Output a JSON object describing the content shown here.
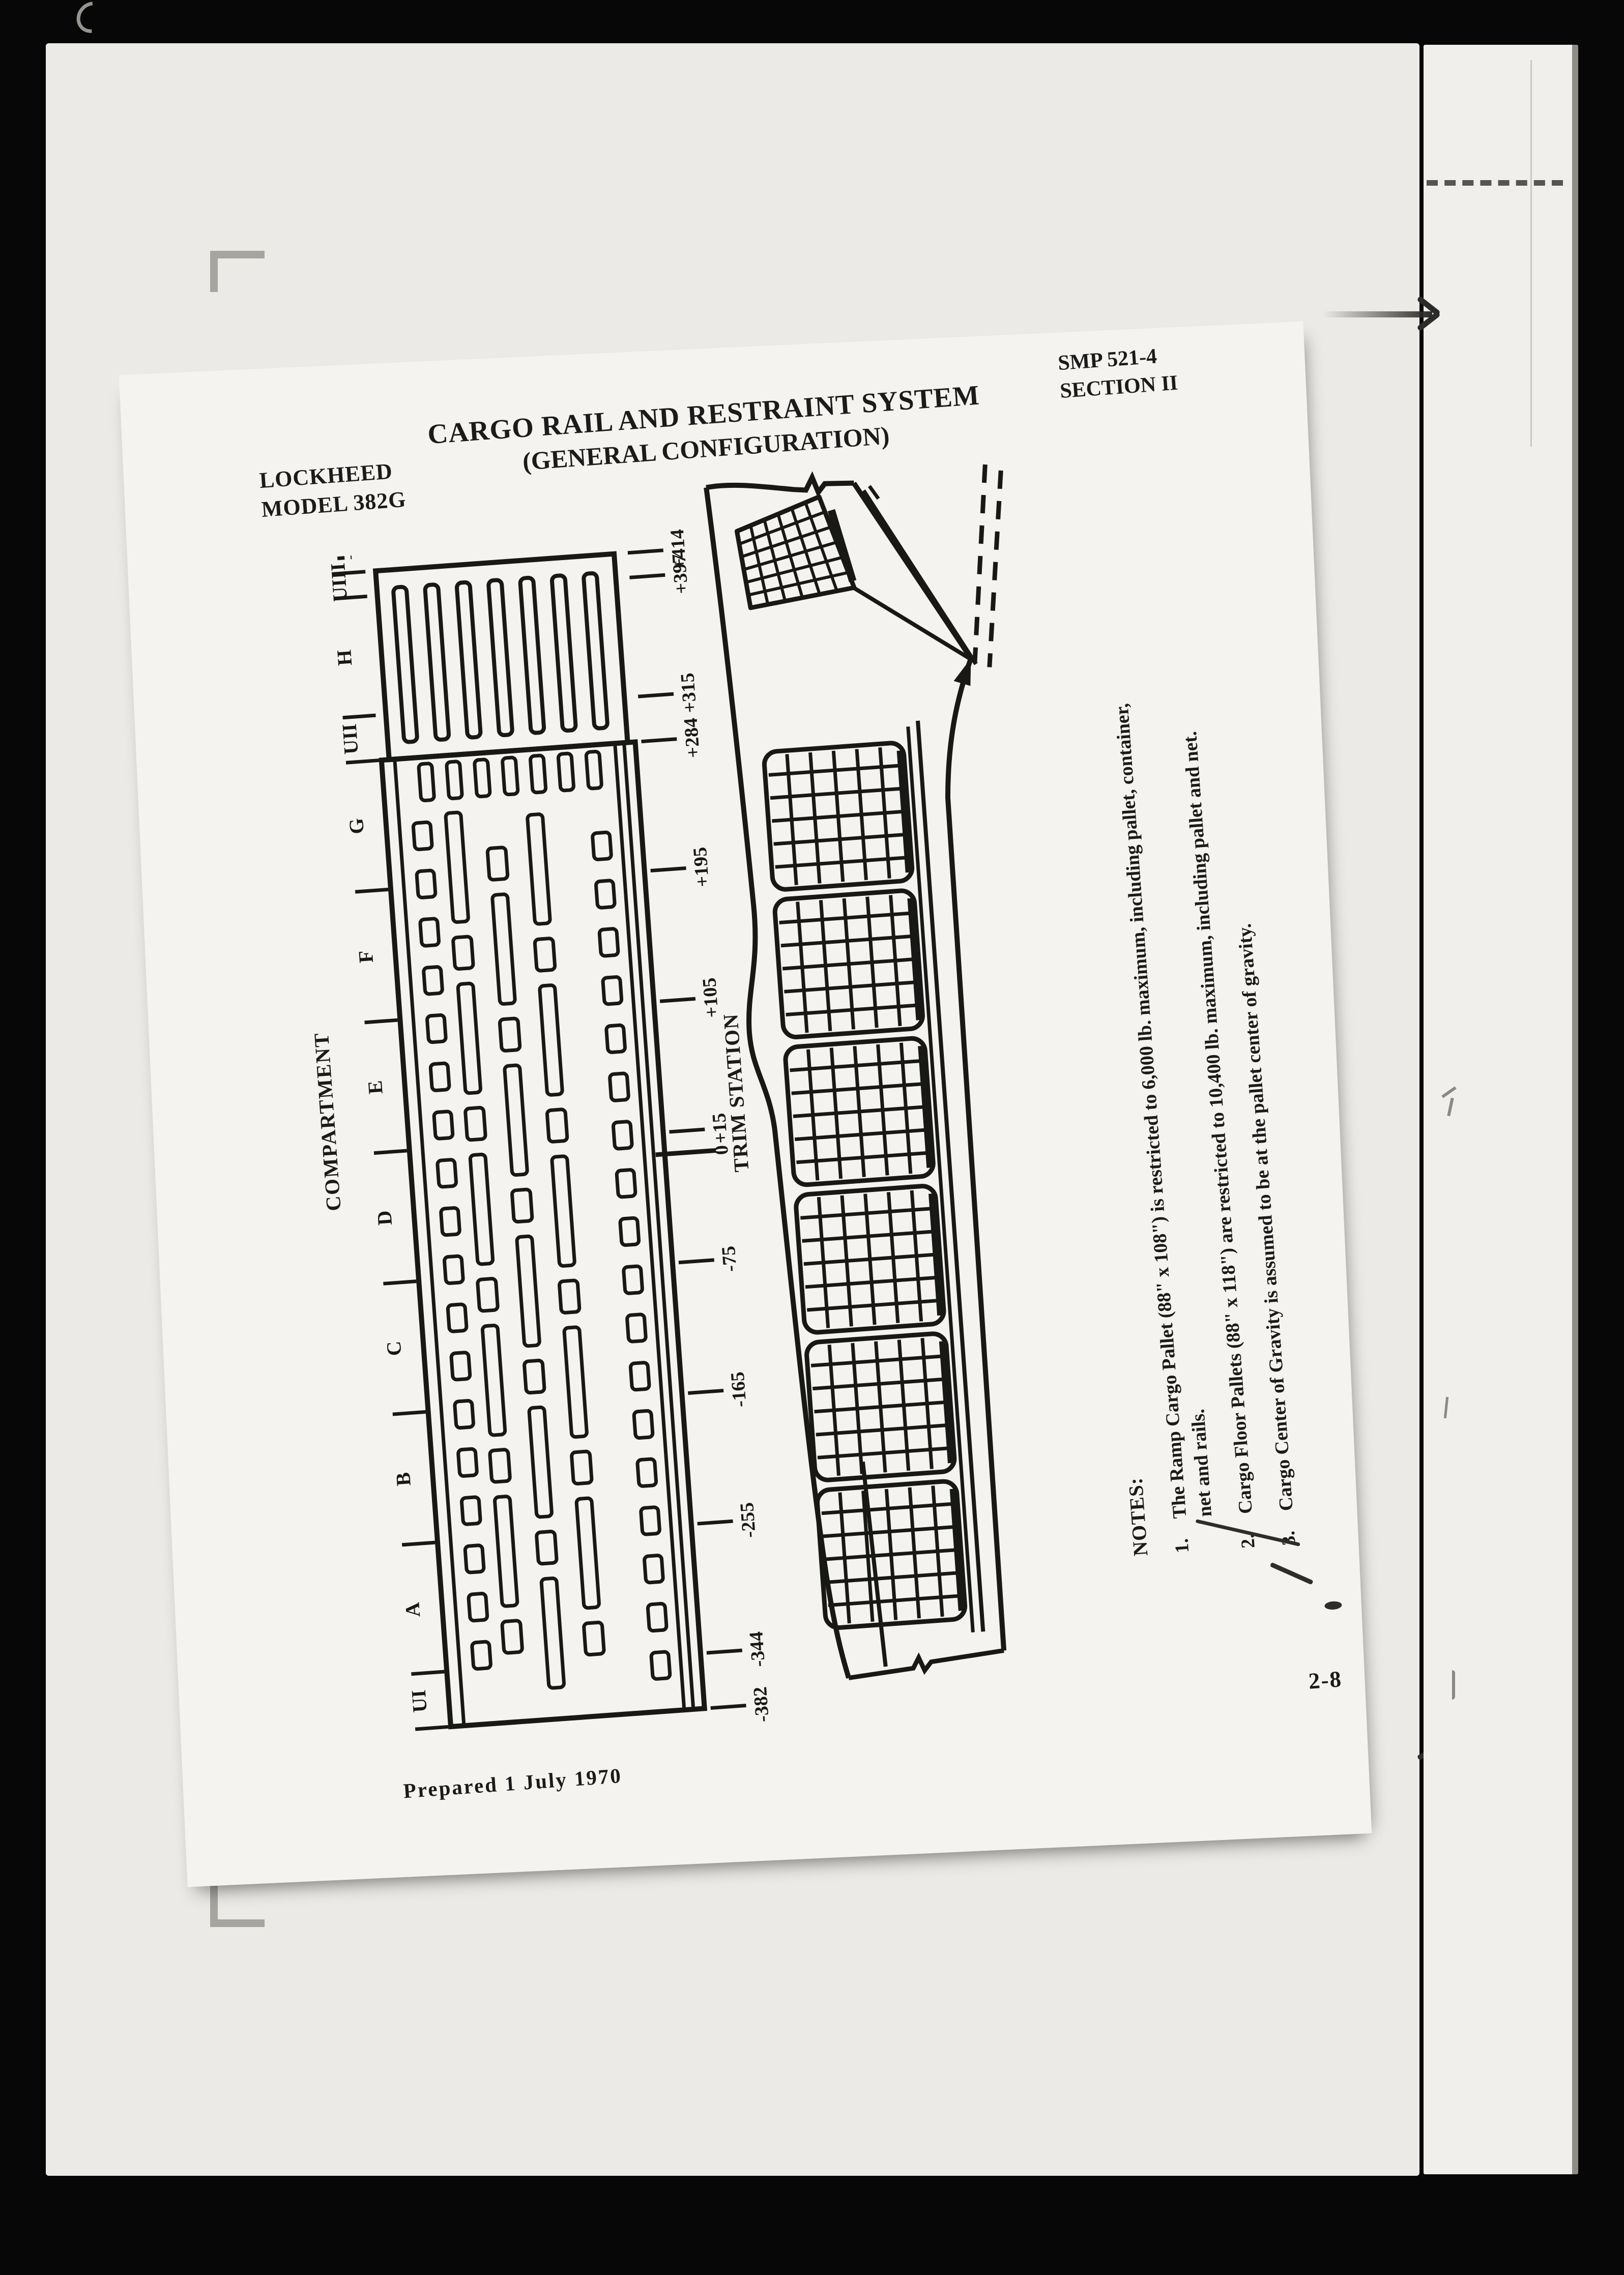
{
  "page": {
    "publisher_line1": "LOCKHEED",
    "publisher_line2": "MODEL 382G",
    "title_line1": "CARGO RAIL AND RESTRAINT SYSTEM",
    "title_line2": "(GENERAL CONFIGURATION)",
    "doc_ref_line1": "SMP 521-4",
    "doc_ref_line2": "SECTION II",
    "prepared": "Prepared 1 July 1970",
    "page_number": "2-8"
  },
  "figure": {
    "compartment_axis_label": "COMPARTMENT",
    "trim_axis_label": "TRIM STATION",
    "compartments": [
      {
        "label": "UIII",
        "station": 408
      },
      {
        "label": "H",
        "station": 356
      },
      {
        "label": "UII",
        "station": 300
      },
      {
        "label": "G",
        "station": 240
      },
      {
        "label": "F",
        "station": 150
      },
      {
        "label": "E",
        "station": 60
      },
      {
        "label": "D",
        "station": -30
      },
      {
        "label": "C",
        "station": -120
      },
      {
        "label": "B",
        "station": -210
      },
      {
        "label": "A",
        "station": -300
      },
      {
        "label": "UI",
        "station": -363
      }
    ],
    "boundary_stations": [
      414,
      397,
      315,
      284,
      195,
      105,
      15,
      -75,
      -165,
      -255,
      -344,
      -382
    ],
    "trim_stations": [
      {
        "label": "+414",
        "station": 414
      },
      {
        "label": "+397",
        "station": 397
      },
      {
        "label": "+315",
        "station": 315
      },
      {
        "label": "+284",
        "station": 284
      },
      {
        "label": "+195",
        "station": 195
      },
      {
        "label": "+105",
        "station": 105
      },
      {
        "label": "+15",
        "station": 15
      },
      {
        "label": "0",
        "station": 0
      },
      {
        "label": "-75",
        "station": -75
      },
      {
        "label": "-165",
        "station": -165
      },
      {
        "label": "-255",
        "station": -255
      },
      {
        "label": "-344",
        "station": -344
      },
      {
        "label": "-382",
        "station": -382
      }
    ]
  },
  "notes": {
    "heading": "NOTES:",
    "items": [
      {
        "num": "1.",
        "text": "The Ramp Cargo Pallet (88\" x 108\") is restricted to 6,000 lb. maximum, including pallet, container, net and rails."
      },
      {
        "num": "2.",
        "text": "Cargo Floor Pallets (88\" x 118\") are restricted to 10,400 lb. maximum, including pallet and net."
      },
      {
        "num": "3.",
        "text": "Cargo Center of Gravity is assumed to be at the pallet center of gravity."
      }
    ]
  },
  "colors": {
    "ink": "#181817",
    "paper": "#f4f3ef",
    "scan_bed": "#eceae6",
    "background": "#070707"
  }
}
